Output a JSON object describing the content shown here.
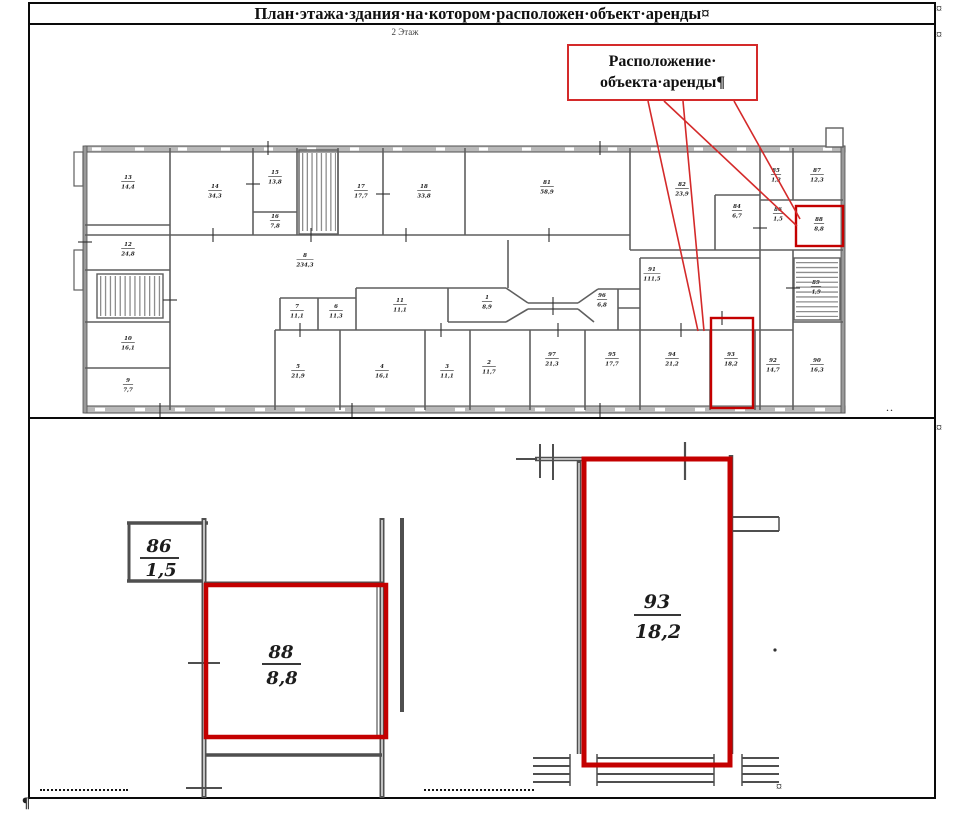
{
  "doc": {
    "title": "План·этажа·здания·на·котором·расположен·объект·аренды¤",
    "floor_label": "2 Этаж",
    "callout": {
      "line1": "Расположение·",
      "line2": "объекта·аренды¶"
    },
    "marks": {
      "row_end": "¤",
      "cell_end": "¤",
      "paragraph": "¶",
      "dots": ".."
    }
  },
  "colors": {
    "highlight_red": "#c40000",
    "callout_border": "#d42a2a",
    "wall_gray": "#5f5f5f",
    "detail_wall_gray": "#4f4f4f"
  },
  "floor_plan": {
    "highlighted_rooms": [
      "88",
      "93"
    ],
    "rooms": [
      {
        "num": "13",
        "area": "14,4",
        "x": 128,
        "y": 182
      },
      {
        "num": "12",
        "area": "24,8",
        "x": 128,
        "y": 249
      },
      {
        "num": "14",
        "area": "34,3",
        "x": 215,
        "y": 191
      },
      {
        "num": "15",
        "area": "13,8",
        "x": 275,
        "y": 177
      },
      {
        "num": "16",
        "area": "7,8",
        "x": 275,
        "y": 221
      },
      {
        "num": "17",
        "area": "17,7",
        "x": 361,
        "y": 191
      },
      {
        "num": "18",
        "area": "33,8",
        "x": 424,
        "y": 191
      },
      {
        "num": "81",
        "area": "58,9",
        "x": 547,
        "y": 187
      },
      {
        "num": "82",
        "area": "23,9",
        "x": 682,
        "y": 189
      },
      {
        "num": "84",
        "area": "6,7",
        "x": 737,
        "y": 211
      },
      {
        "num": "85",
        "area": "1,2",
        "x": 776,
        "y": 175
      },
      {
        "num": "87",
        "area": "12,3",
        "x": 817,
        "y": 175
      },
      {
        "num": "86",
        "area": "1,5",
        "x": 778,
        "y": 214
      },
      {
        "num": "88",
        "area": "8,8",
        "x": 819,
        "y": 224
      },
      {
        "num": "10",
        "area": "16,1",
        "x": 128,
        "y": 343
      },
      {
        "num": "9",
        "area": "7,7",
        "x": 128,
        "y": 385
      },
      {
        "num": "8",
        "area": "234,3",
        "x": 305,
        "y": 260
      },
      {
        "num": "7",
        "area": "11,1",
        "x": 297,
        "y": 311
      },
      {
        "num": "6",
        "area": "11,3",
        "x": 336,
        "y": 311
      },
      {
        "num": "11",
        "area": "11,1",
        "x": 400,
        "y": 305
      },
      {
        "num": "5",
        "area": "21,9",
        "x": 298,
        "y": 371
      },
      {
        "num": "4",
        "area": "16,1",
        "x": 382,
        "y": 371
      },
      {
        "num": "3",
        "area": "11,1",
        "x": 447,
        "y": 371
      },
      {
        "num": "1",
        "area": "8,9",
        "x": 487,
        "y": 302
      },
      {
        "num": "2",
        "area": "11,7",
        "x": 489,
        "y": 367
      },
      {
        "num": "91",
        "area": "111,5",
        "x": 652,
        "y": 274
      },
      {
        "num": "96",
        "area": "6,8",
        "x": 602,
        "y": 300
      },
      {
        "num": "97",
        "area": "21,3",
        "x": 552,
        "y": 359
      },
      {
        "num": "95",
        "area": "17,7",
        "x": 612,
        "y": 359
      },
      {
        "num": "94",
        "area": "21,2",
        "x": 672,
        "y": 359
      },
      {
        "num": "93",
        "area": "18,2",
        "x": 731,
        "y": 359
      },
      {
        "num": "92",
        "area": "14,7",
        "x": 773,
        "y": 365
      },
      {
        "num": "90",
        "area": "16,3",
        "x": 817,
        "y": 365
      },
      {
        "num": "89",
        "area": "4,9",
        "x": 816,
        "y": 287
      }
    ]
  },
  "details": {
    "left": {
      "room_adjacent": {
        "num": "86",
        "area": "1,5"
      },
      "room_main": {
        "num": "88",
        "area": "8,8"
      }
    },
    "right": {
      "room_main": {
        "num": "93",
        "area": "18,2"
      }
    }
  }
}
